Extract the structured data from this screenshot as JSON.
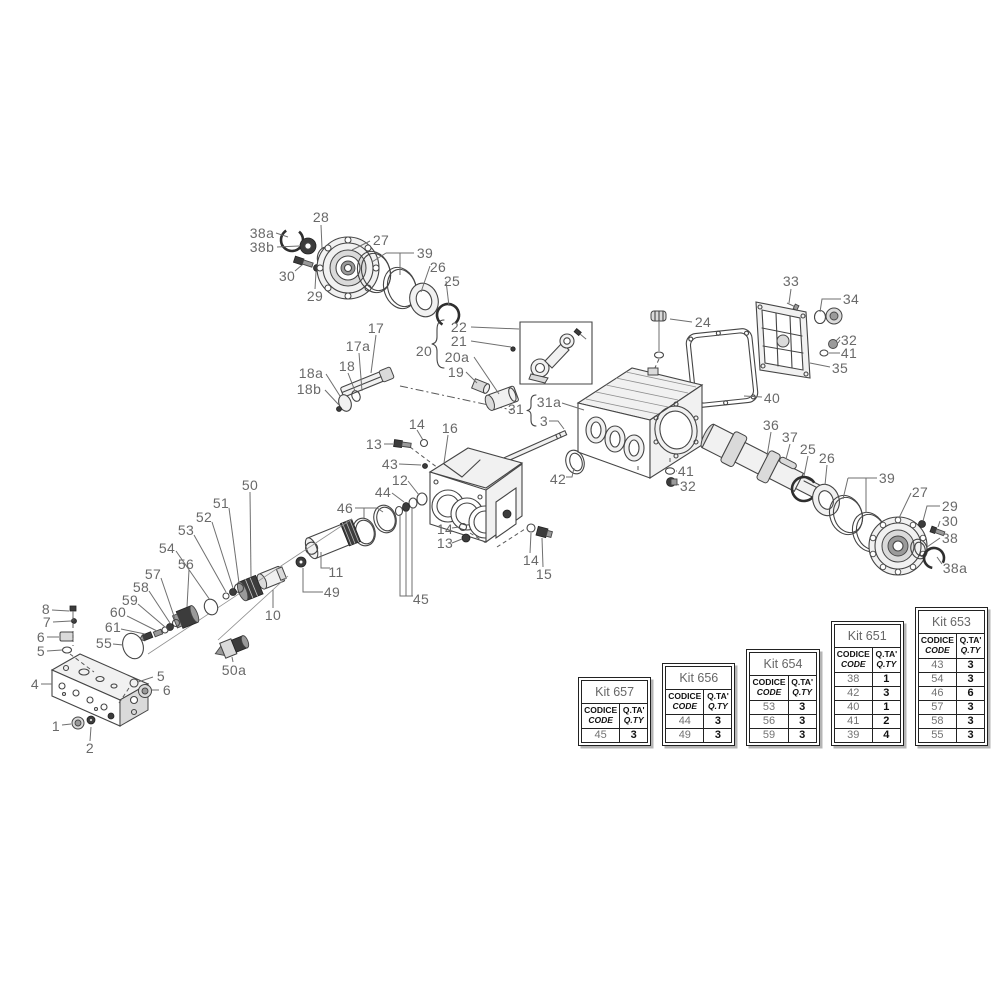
{
  "labels": [
    {
      "text": "38a",
      "x": 262,
      "y": 233
    },
    {
      "text": "38b",
      "x": 262,
      "y": 247
    },
    {
      "text": "28",
      "x": 321,
      "y": 217
    },
    {
      "text": "27",
      "x": 381,
      "y": 240
    },
    {
      "text": "30",
      "x": 287,
      "y": 276
    },
    {
      "text": "29",
      "x": 315,
      "y": 296
    },
    {
      "text": "39",
      "x": 425,
      "y": 253
    },
    {
      "text": "26",
      "x": 438,
      "y": 267
    },
    {
      "text": "25",
      "x": 452,
      "y": 281
    },
    {
      "text": "17",
      "x": 376,
      "y": 328
    },
    {
      "text": "17a",
      "x": 358,
      "y": 346
    },
    {
      "text": "18",
      "x": 347,
      "y": 366
    },
    {
      "text": "18a",
      "x": 311,
      "y": 373
    },
    {
      "text": "18b",
      "x": 309,
      "y": 389
    },
    {
      "text": "20",
      "x": 424,
      "y": 351
    },
    {
      "text": "22",
      "x": 459,
      "y": 327
    },
    {
      "text": "21",
      "x": 459,
      "y": 341
    },
    {
      "text": "20a",
      "x": 457,
      "y": 357
    },
    {
      "text": "19",
      "x": 456,
      "y": 372
    },
    {
      "text": "24",
      "x": 703,
      "y": 322
    },
    {
      "text": "33",
      "x": 791,
      "y": 281
    },
    {
      "text": "34",
      "x": 851,
      "y": 299
    },
    {
      "text": "32",
      "x": 849,
      "y": 340
    },
    {
      "text": "41",
      "x": 849,
      "y": 353
    },
    {
      "text": "35",
      "x": 840,
      "y": 368
    },
    {
      "text": "40",
      "x": 772,
      "y": 398
    },
    {
      "text": "31",
      "x": 516,
      "y": 409
    },
    {
      "text": "31a",
      "x": 549,
      "y": 402
    },
    {
      "text": "3",
      "x": 544,
      "y": 421
    },
    {
      "text": "42",
      "x": 558,
      "y": 479
    },
    {
      "text": "41",
      "x": 686,
      "y": 471
    },
    {
      "text": "32",
      "x": 688,
      "y": 486
    },
    {
      "text": "36",
      "x": 771,
      "y": 425
    },
    {
      "text": "37",
      "x": 790,
      "y": 437
    },
    {
      "text": "25",
      "x": 808,
      "y": 449
    },
    {
      "text": "26",
      "x": 827,
      "y": 458
    },
    {
      "text": "39",
      "x": 887,
      "y": 478
    },
    {
      "text": "27",
      "x": 920,
      "y": 492
    },
    {
      "text": "29",
      "x": 950,
      "y": 506
    },
    {
      "text": "30",
      "x": 950,
      "y": 521
    },
    {
      "text": "38",
      "x": 950,
      "y": 538
    },
    {
      "text": "38a",
      "x": 955,
      "y": 568
    },
    {
      "text": "16",
      "x": 450,
      "y": 428
    },
    {
      "text": "14",
      "x": 417,
      "y": 424
    },
    {
      "text": "13",
      "x": 374,
      "y": 444
    },
    {
      "text": "43",
      "x": 390,
      "y": 464
    },
    {
      "text": "12",
      "x": 400,
      "y": 480
    },
    {
      "text": "44",
      "x": 383,
      "y": 492
    },
    {
      "text": "46",
      "x": 345,
      "y": 508
    },
    {
      "text": "50",
      "x": 250,
      "y": 485
    },
    {
      "text": "51",
      "x": 221,
      "y": 503
    },
    {
      "text": "52",
      "x": 204,
      "y": 517
    },
    {
      "text": "53",
      "x": 186,
      "y": 530
    },
    {
      "text": "54",
      "x": 167,
      "y": 548
    },
    {
      "text": "56",
      "x": 186,
      "y": 564
    },
    {
      "text": "57",
      "x": 153,
      "y": 574
    },
    {
      "text": "58",
      "x": 141,
      "y": 587
    },
    {
      "text": "59",
      "x": 130,
      "y": 600
    },
    {
      "text": "60",
      "x": 118,
      "y": 612
    },
    {
      "text": "61",
      "x": 113,
      "y": 627
    },
    {
      "text": "55",
      "x": 104,
      "y": 643
    },
    {
      "text": "11",
      "x": 336,
      "y": 572
    },
    {
      "text": "49",
      "x": 332,
      "y": 592
    },
    {
      "text": "10",
      "x": 273,
      "y": 615
    },
    {
      "text": "45",
      "x": 421,
      "y": 599
    },
    {
      "text": "50a",
      "x": 234,
      "y": 670
    },
    {
      "text": "14",
      "x": 445,
      "y": 529
    },
    {
      "text": "13",
      "x": 445,
      "y": 543
    },
    {
      "text": "14",
      "x": 531,
      "y": 560
    },
    {
      "text": "15",
      "x": 544,
      "y": 574
    },
    {
      "text": "8",
      "x": 46,
      "y": 609
    },
    {
      "text": "7",
      "x": 47,
      "y": 622
    },
    {
      "text": "6",
      "x": 41,
      "y": 637
    },
    {
      "text": "5",
      "x": 41,
      "y": 651
    },
    {
      "text": "4",
      "x": 35,
      "y": 684
    },
    {
      "text": "5",
      "x": 161,
      "y": 676
    },
    {
      "text": "6",
      "x": 167,
      "y": 690
    },
    {
      "text": "1",
      "x": 56,
      "y": 726
    },
    {
      "text": "2",
      "x": 90,
      "y": 748
    }
  ],
  "kits": {
    "header": {
      "code_line1": "CODICE",
      "code_line2": "CODE",
      "qty_line1": "Q.TA'",
      "qty_line2": "Q.TY"
    },
    "tables": [
      {
        "title": "Kit 657",
        "rows": [
          [
            "45",
            "3"
          ]
        ]
      },
      {
        "title": "Kit 656",
        "rows": [
          [
            "44",
            "3"
          ],
          [
            "49",
            "3"
          ]
        ]
      },
      {
        "title": "Kit 654",
        "rows": [
          [
            "53",
            "3"
          ],
          [
            "56",
            "3"
          ],
          [
            "59",
            "3"
          ]
        ]
      },
      {
        "title": "Kit 651",
        "rows": [
          [
            "38",
            "1"
          ],
          [
            "42",
            "3"
          ],
          [
            "40",
            "1"
          ],
          [
            "41",
            "2"
          ],
          [
            "39",
            "4"
          ]
        ]
      },
      {
        "title": "Kit 653",
        "rows": [
          [
            "43",
            "3"
          ],
          [
            "54",
            "3"
          ],
          [
            "46",
            "6"
          ],
          [
            "57",
            "3"
          ],
          [
            "58",
            "3"
          ],
          [
            "55",
            "3"
          ]
        ]
      }
    ]
  }
}
